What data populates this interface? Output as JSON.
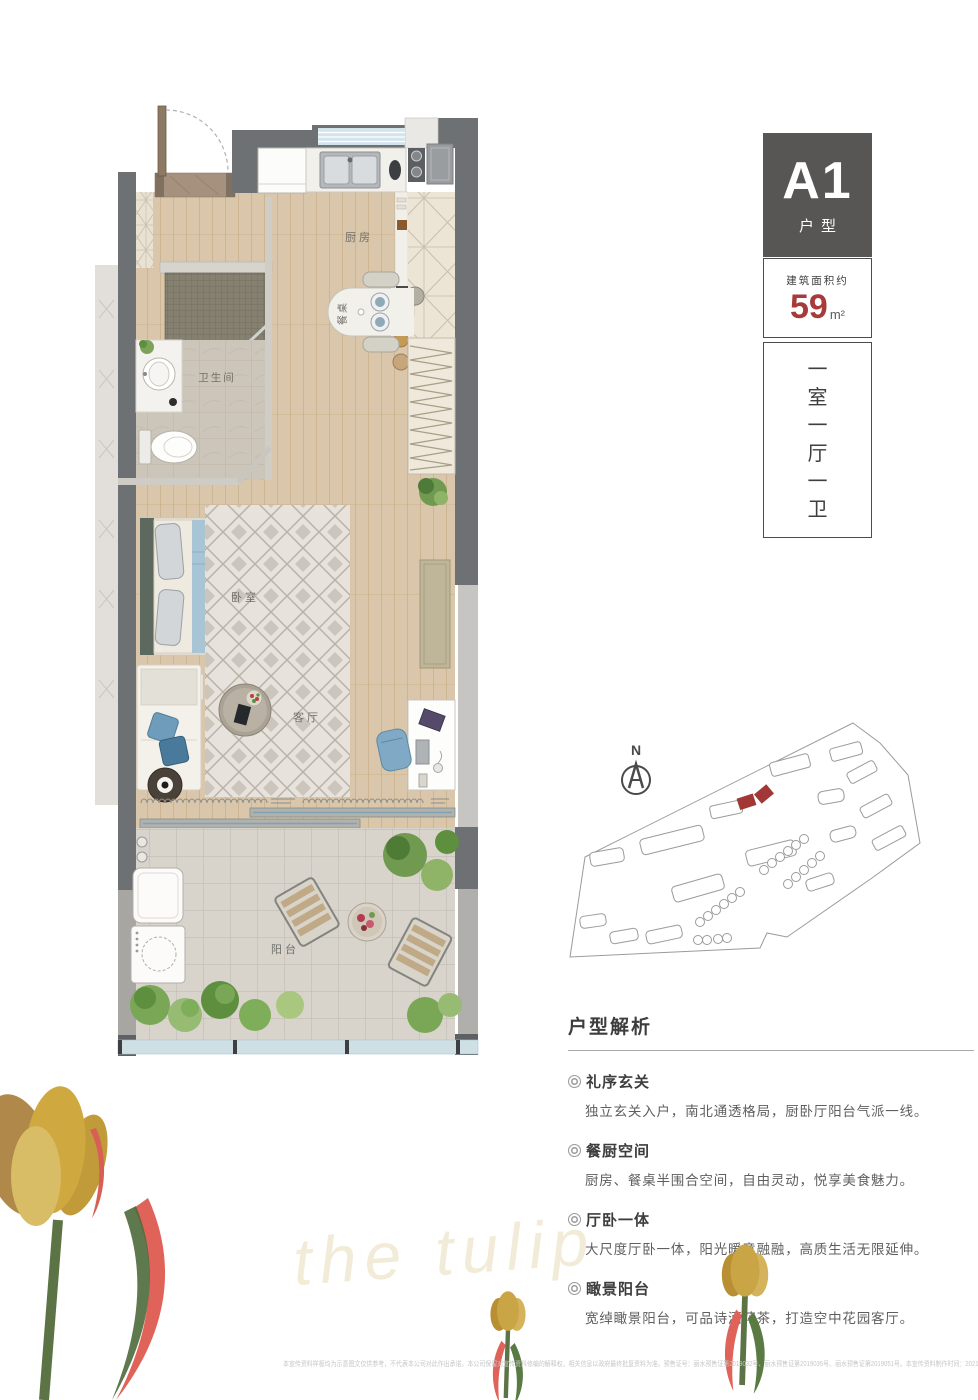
{
  "unit": {
    "code": "A1",
    "code_suffix": "户型",
    "area_label": "建筑面积约",
    "area_value": "59",
    "area_unit": "m²",
    "layout_chars": [
      "一",
      "室",
      "一",
      "厅",
      "一",
      "卫"
    ]
  },
  "floorplan": {
    "rooms": {
      "kitchen": "厨房",
      "dining": "餐桌",
      "bathroom": "卫生间",
      "bedroom": "卧室",
      "living": "客厅",
      "balcony": "阳台"
    }
  },
  "siteplan": {
    "north_label": "N",
    "highlight_color": "#a23835"
  },
  "analysis": {
    "title": "户型解析",
    "items": [
      {
        "heading": "礼序玄关",
        "desc": "独立玄关入户，南北通透格局，厨卧厅阳台气派一线。"
      },
      {
        "heading": "餐厨空间",
        "desc": "厨房、餐桌半围合空间，自由灵动，悦享美食魅力。"
      },
      {
        "heading": "厅卧一体",
        "desc": "大尺度厅卧一体，阳光暖意融融，高质生活无限延伸。"
      },
      {
        "heading": "瞰景阳台",
        "desc": "宽绰瞰景阳台，可品诗酒花茶，打造空中花园客厅。"
      }
    ]
  },
  "decor": {
    "script_text": "the tulip"
  },
  "footer": {
    "disclaimer": "本宣传资料样板均为示意图文仅供参考，不代表本公司对此作出承诺。本公司保留对宣传资料修编的解释权，相关信息以政府最终批复资料为准。预售证号：丽水预售证第2019032号、丽水预售证第2019035号、丽水预售证第2019051号。本宣传资料制作时间：2021年6月。"
  },
  "colors": {
    "accent_red": "#a93a3a",
    "badge_gray": "#585555",
    "wall_gray": "#6d7174",
    "window_blue": "#d3e5eb",
    "site_highlight": "#a23835"
  }
}
